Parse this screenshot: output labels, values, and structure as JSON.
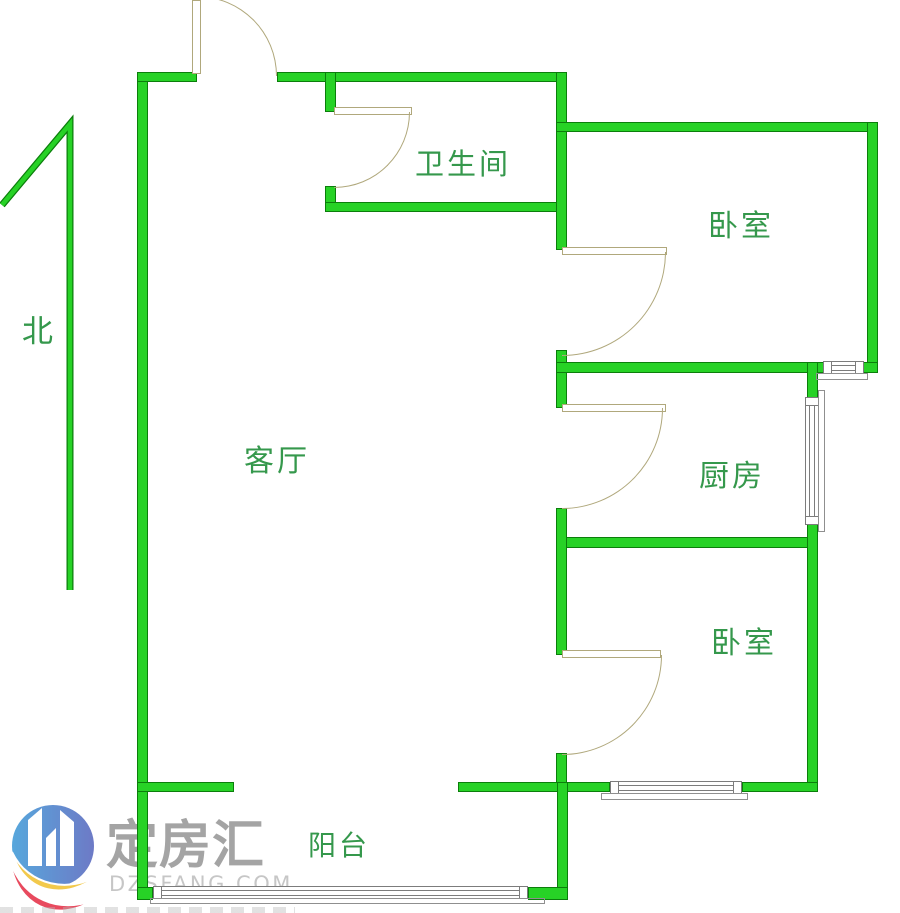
{
  "title": "apartment-floorplan",
  "watermark": {
    "brand": "定房汇",
    "domain": "DZSFANG.COM"
  },
  "compass": {
    "label": "北"
  },
  "rooms": [
    {
      "id": "bathroom",
      "label": "卫生间",
      "x": 415,
      "y": 141,
      "size": 29
    },
    {
      "id": "bedroom-north",
      "label": "卧室",
      "x": 708,
      "y": 201,
      "size": 30
    },
    {
      "id": "kitchen",
      "label": "厨房",
      "x": 699,
      "y": 451,
      "size": 30
    },
    {
      "id": "bedroom-south",
      "label": "卧室",
      "x": 711,
      "y": 618,
      "size": 30
    },
    {
      "id": "living-room",
      "label": "客厅",
      "x": 244,
      "y": 436,
      "size": 30
    },
    {
      "id": "balcony",
      "label": "阳台",
      "x": 308,
      "y": 824,
      "size": 28
    }
  ],
  "palette": {
    "wall-fill": "#27d226",
    "wall-edge": "#0b7e0b",
    "door-line": "#b0a87c",
    "window-line": "#7c7c7c",
    "sill-line": "#8f8f8f",
    "label-color": "#35984c",
    "wm-text": "#9d9d9d",
    "wm-sub": "#c4c4c4",
    "logo-blue1": "#57a7dc",
    "logo-blue2": "#6d7ac6",
    "logo-red": "#e84a5e",
    "logo-yellow": "#f2c94c"
  },
  "geometry": {
    "walls": [
      [
        137,
        72,
        11,
        828
      ],
      [
        137,
        72,
        60,
        10
      ],
      [
        277,
        72,
        290,
        10
      ],
      [
        325,
        72,
        11,
        40
      ],
      [
        325,
        186,
        11,
        26
      ],
      [
        325,
        202,
        235,
        10
      ],
      [
        556,
        72,
        11,
        178
      ],
      [
        556,
        122,
        322,
        10
      ],
      [
        867,
        122,
        11,
        250
      ],
      [
        556,
        350,
        11,
        58
      ],
      [
        556,
        362,
        269,
        11
      ],
      [
        807,
        362,
        11,
        38
      ],
      [
        862,
        362,
        16,
        11
      ],
      [
        556,
        537,
        262,
        11
      ],
      [
        807,
        522,
        11,
        270
      ],
      [
        556,
        508,
        11,
        147
      ],
      [
        556,
        753,
        11,
        39
      ],
      [
        137,
        782,
        97,
        10
      ],
      [
        458,
        782,
        152,
        10
      ],
      [
        742,
        782,
        76,
        10
      ],
      [
        557,
        782,
        11,
        118
      ],
      [
        137,
        887,
        16,
        13
      ],
      [
        528,
        887,
        40,
        13
      ]
    ],
    "windows": [
      {
        "x": 823,
        "y": 361,
        "w": 41,
        "h": 13,
        "o": "h"
      },
      {
        "x": 805,
        "y": 397,
        "w": 14,
        "h": 128,
        "o": "v"
      },
      {
        "x": 610,
        "y": 781,
        "w": 132,
        "h": 13,
        "o": "h"
      },
      {
        "x": 153,
        "y": 886,
        "w": 375,
        "h": 13,
        "o": "h"
      }
    ],
    "sills": [
      [
        816,
        373,
        52,
        7
      ],
      [
        818,
        390,
        7,
        142
      ],
      [
        601,
        793,
        147,
        7
      ],
      [
        150,
        898,
        395,
        6
      ]
    ],
    "doors": {
      "leaves": [
        [
          192,
          0,
          9,
          74
        ],
        [
          334,
          107,
          78,
          8
        ],
        [
          562,
          247,
          105,
          8
        ],
        [
          562,
          404,
          104,
          8
        ],
        [
          562,
          650,
          99,
          8
        ]
      ],
      "arcs": [
        {
          "x": 197,
          "y": -4,
          "r": 80,
          "q": "tr"
        },
        {
          "x": 334,
          "y": 112,
          "r": 76,
          "q": "br"
        },
        {
          "x": 562,
          "y": 252,
          "r": 104,
          "q": "br"
        },
        {
          "x": 562,
          "y": 408,
          "r": 101,
          "q": "br"
        },
        {
          "x": 562,
          "y": 655,
          "r": 100,
          "q": "br"
        }
      ]
    },
    "north_arrow": {
      "points": [
        [
          2,
          205
        ],
        [
          70,
          124
        ],
        [
          70,
          590
        ]
      ]
    }
  }
}
